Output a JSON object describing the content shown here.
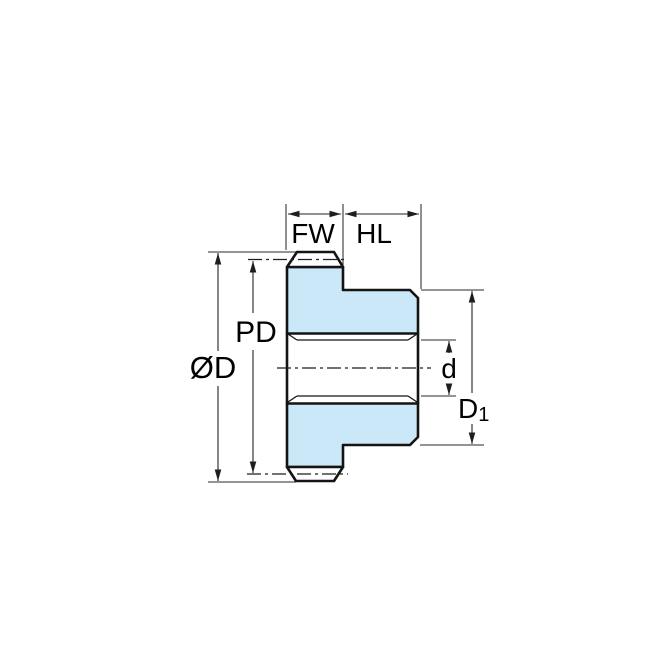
{
  "diagram": {
    "type": "technical-drawing",
    "subject": "spur-gear-side-cross-section",
    "labels": {
      "face_width": "FW",
      "hub_length": "HL",
      "outside_diameter": "ØD",
      "pitch_diameter": "PD",
      "bore_diameter": "d",
      "hub_diameter_base": "D",
      "hub_diameter_subscript": "1"
    },
    "colors": {
      "section_fill": "#cae8f7",
      "outline": "#141414",
      "dimension_lines": "#222222",
      "background": "#ffffff"
    }
  }
}
